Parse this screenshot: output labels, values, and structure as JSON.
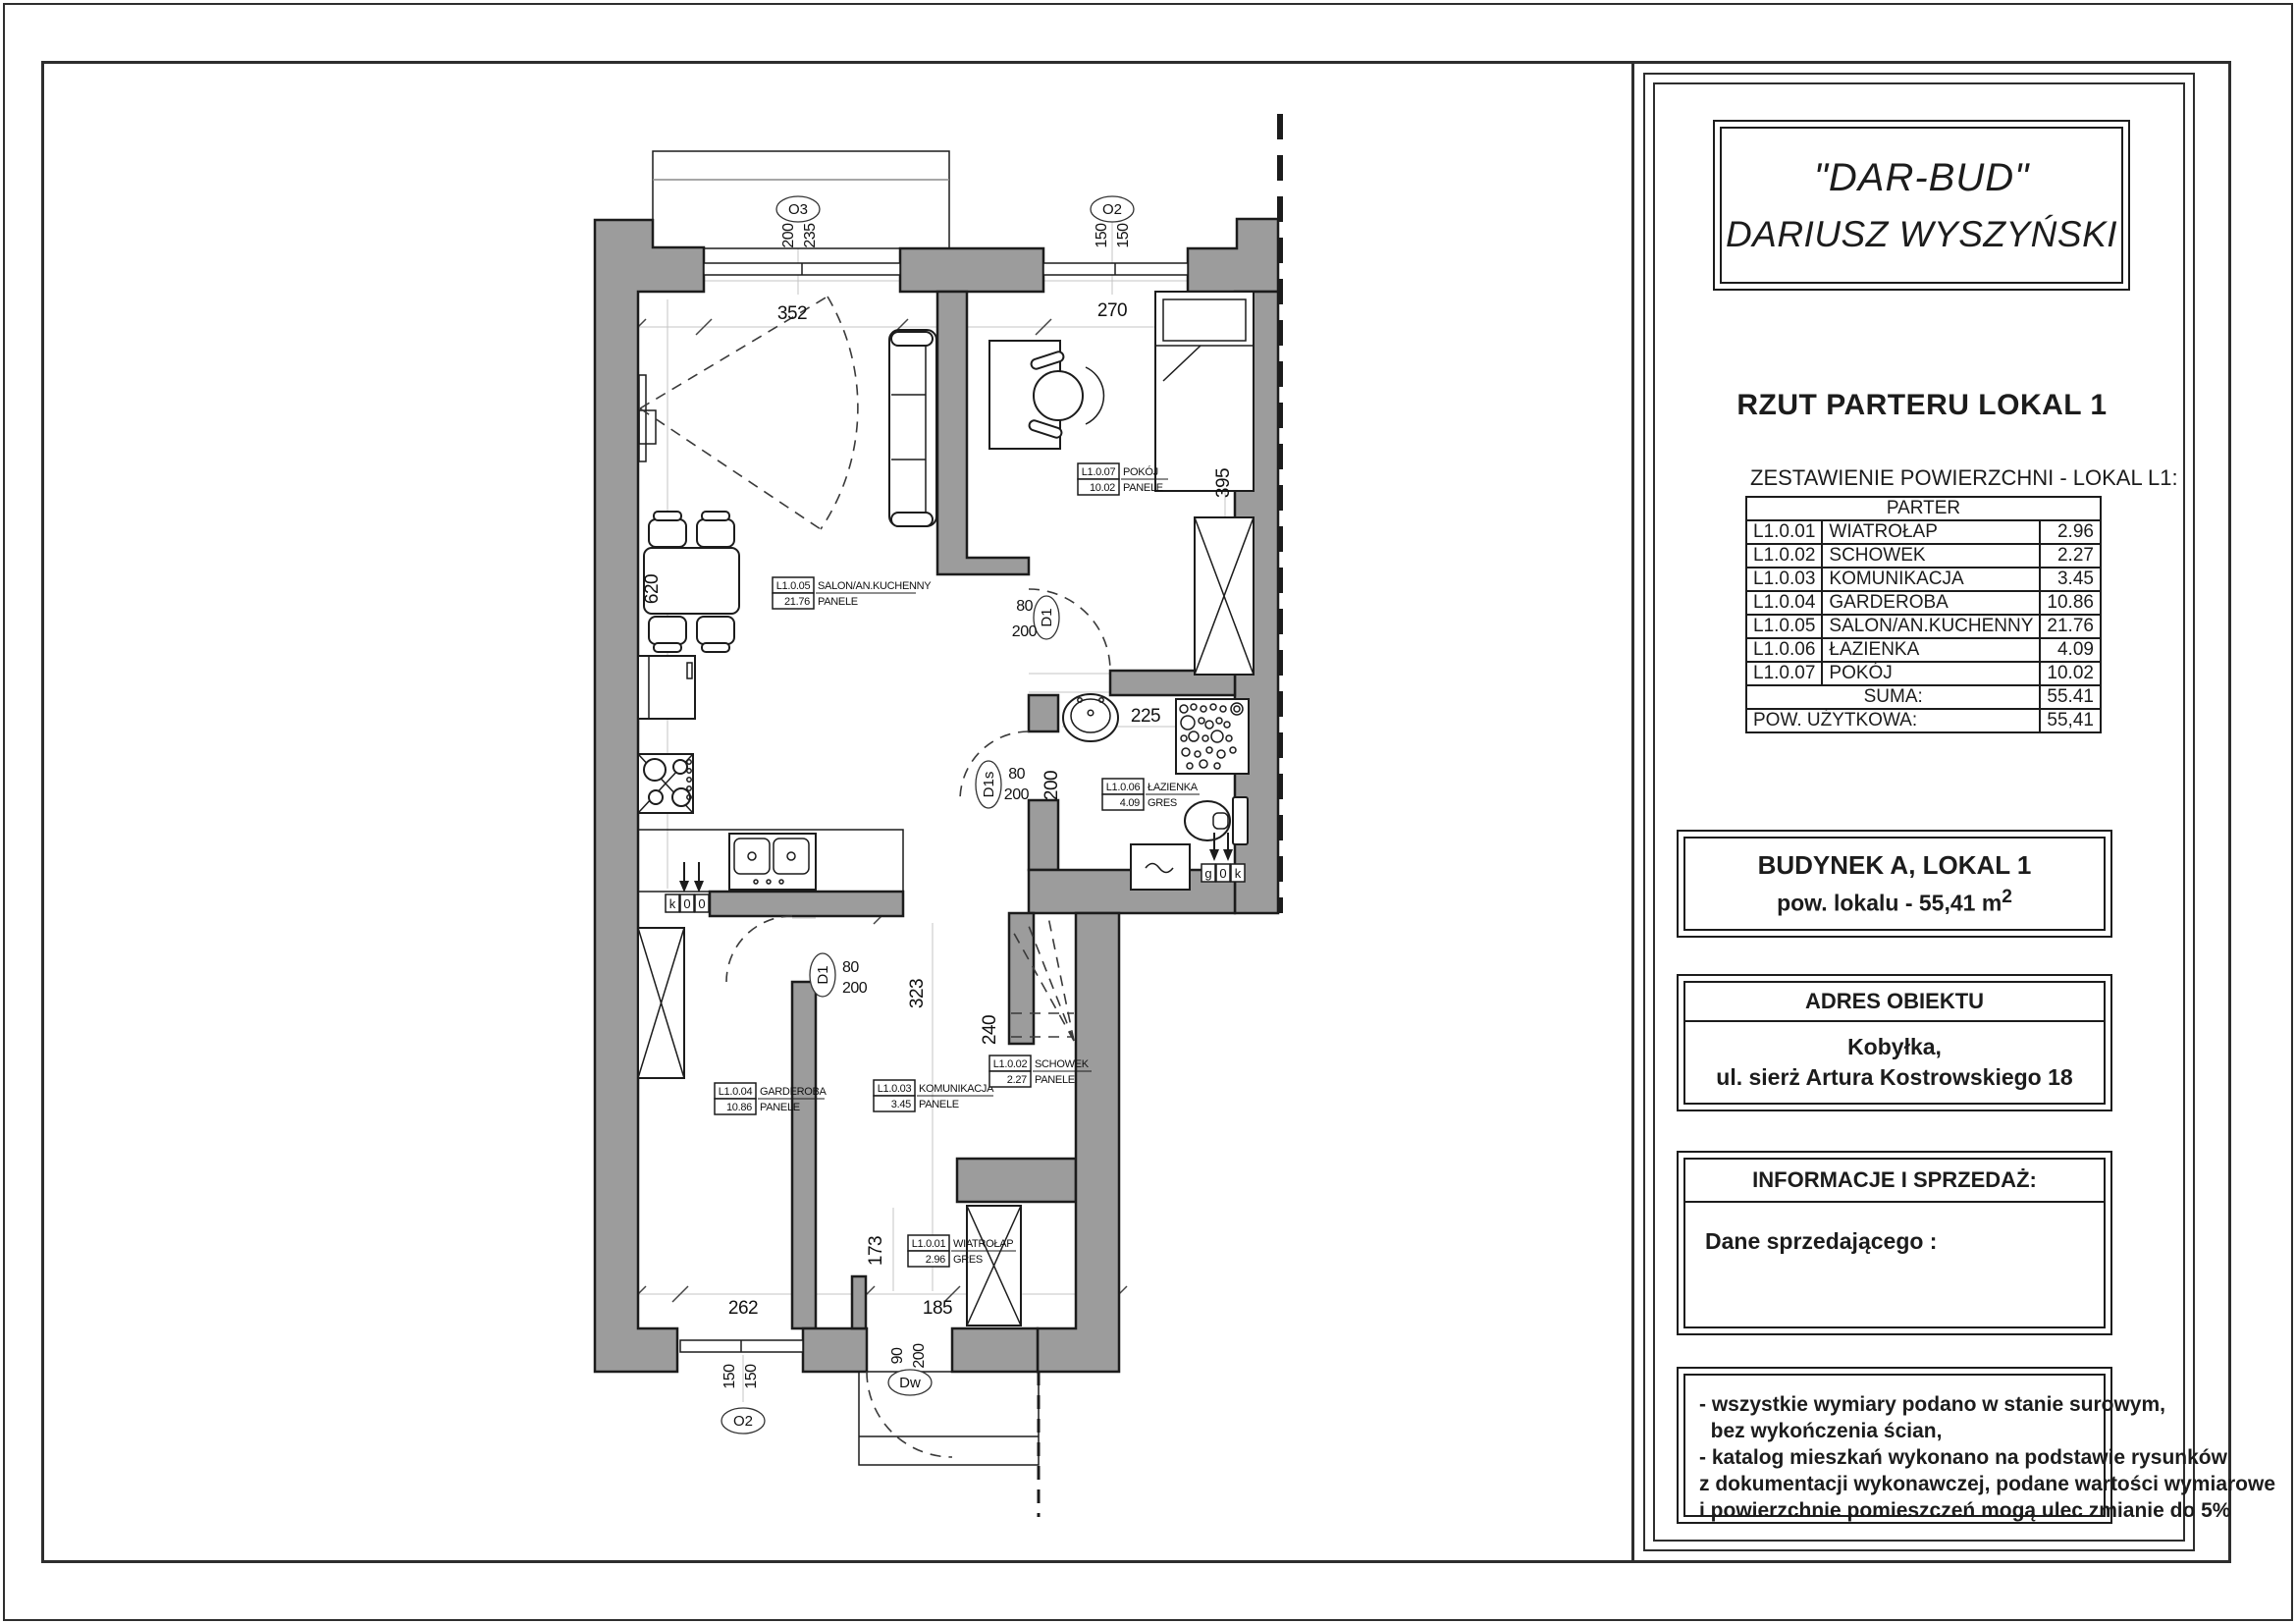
{
  "panel": {
    "logo_line1": "\"DAR-BUD\"",
    "logo_line2": "DARIUSZ WYSZYŃSKI",
    "title": "RZUT PARTERU LOKAL 1",
    "table_caption": "ZESTAWIENIE POWIERZCHNI  - LOKAL L1:",
    "table_header": "PARTER",
    "rooms": [
      {
        "code": "L1.0.01",
        "name": "WIATROŁAP",
        "area": "2.96"
      },
      {
        "code": "L1.0.02",
        "name": "SCHOWEK",
        "area": "2.27"
      },
      {
        "code": "L1.0.03",
        "name": "KOMUNIKACJA",
        "area": "3.45"
      },
      {
        "code": "L1.0.04",
        "name": "GARDEROBA",
        "area": "10.86"
      },
      {
        "code": "L1.0.05",
        "name": "SALON/AN.KUCHENNY",
        "area": "21.76"
      },
      {
        "code": "L1.0.06",
        "name": "ŁAZIENKA",
        "area": "4.09"
      },
      {
        "code": "L1.0.07",
        "name": "POKÓJ",
        "area": "10.02"
      }
    ],
    "suma_label": "SUMA:",
    "suma_value": "55.41",
    "pow_label": "POW. UŻYTKOWA:",
    "pow_value": "55,41",
    "building": {
      "line1": "BUDYNEK A, LOKAL 1",
      "line2": "pow. lokalu  - 55,41 m",
      "sup": "2"
    },
    "address": {
      "header": "ADRES OBIEKTU",
      "line1": "Kobyłka,",
      "line2": "ul. sierż Artura Kostrowskiego 18"
    },
    "info": {
      "header": "INFORMACJE I SPRZEDAŻ:",
      "body": "Dane sprzedającego :"
    },
    "notes": [
      "- wszystkie wymiary podano w stanie surowym,",
      "  bez wykończenia ścian,",
      "- katalog mieszkań wykonano na podstawie rysunków",
      "z dokumentacji wykonawczej, podane wartości wymiarowe",
      "i powierzchnie pomieszczeń mogą ulec zmianie do 5%"
    ]
  },
  "plan": {
    "room_labels": {
      "salon": {
        "code": "L1.0.05",
        "name": "SALON/AN.KUCHENNY",
        "area": "21.76",
        "floor": "PANELE"
      },
      "pokoj": {
        "code": "L1.0.07",
        "name": "POKÓJ",
        "area": "10.02",
        "floor": "PANELE"
      },
      "lazienka": {
        "code": "L1.0.06",
        "name": "ŁAZIENKA",
        "area": "4.09",
        "floor": "GRES"
      },
      "garderoba": {
        "code": "L1.0.04",
        "name": "GARDEROBA",
        "area": "10.86",
        "floor": "PANELE"
      },
      "komunikacja": {
        "code": "L1.0.03",
        "name": "KOMUNIKACJA",
        "area": "3.45",
        "floor": "PANELE"
      },
      "schowek": {
        "code": "L1.0.02",
        "name": "SCHOWEK",
        "area": "2.27",
        "floor": "PANELE"
      },
      "wiatrolap": {
        "code": "L1.0.01",
        "name": "WIATROŁAP",
        "area": "2.96",
        "floor": "GRES"
      }
    },
    "dims": {
      "salon_top": "352",
      "pokoj_top": "270",
      "salon_left": "620",
      "pokoj_right": "395",
      "lazienka_top": "225",
      "lazienka_left": "200",
      "komunikacja": "323",
      "schowek": "240",
      "wiatrolap": "173",
      "garderoba_bottom": "262",
      "wiatrolap_bottom": "185"
    },
    "windows": {
      "o3": {
        "label": "O3",
        "dim1": "200",
        "dim2": "235"
      },
      "o2_top": {
        "label": "O2",
        "dim1": "150",
        "dim2": "150"
      },
      "o2_bottom": {
        "label": "O2",
        "dim1": "150",
        "dim2": "150"
      }
    },
    "doors": {
      "d1_pokoj": {
        "label": "D1",
        "w": "80",
        "h": "200"
      },
      "d1s_lazienka": {
        "label": "D1s",
        "w": "80",
        "h": "200"
      },
      "d1_garderoba": {
        "label": "D1",
        "w": "80",
        "h": "200"
      },
      "dw_entry": {
        "label": "Dw",
        "w": "90",
        "h": "200"
      }
    },
    "kitchen_boxes": [
      "k",
      "0",
      "0"
    ],
    "bath_boxes": [
      "g",
      "0",
      "k"
    ]
  },
  "colors": {
    "wall": "#9c9c9c",
    "line": "#1c1c1c"
  }
}
